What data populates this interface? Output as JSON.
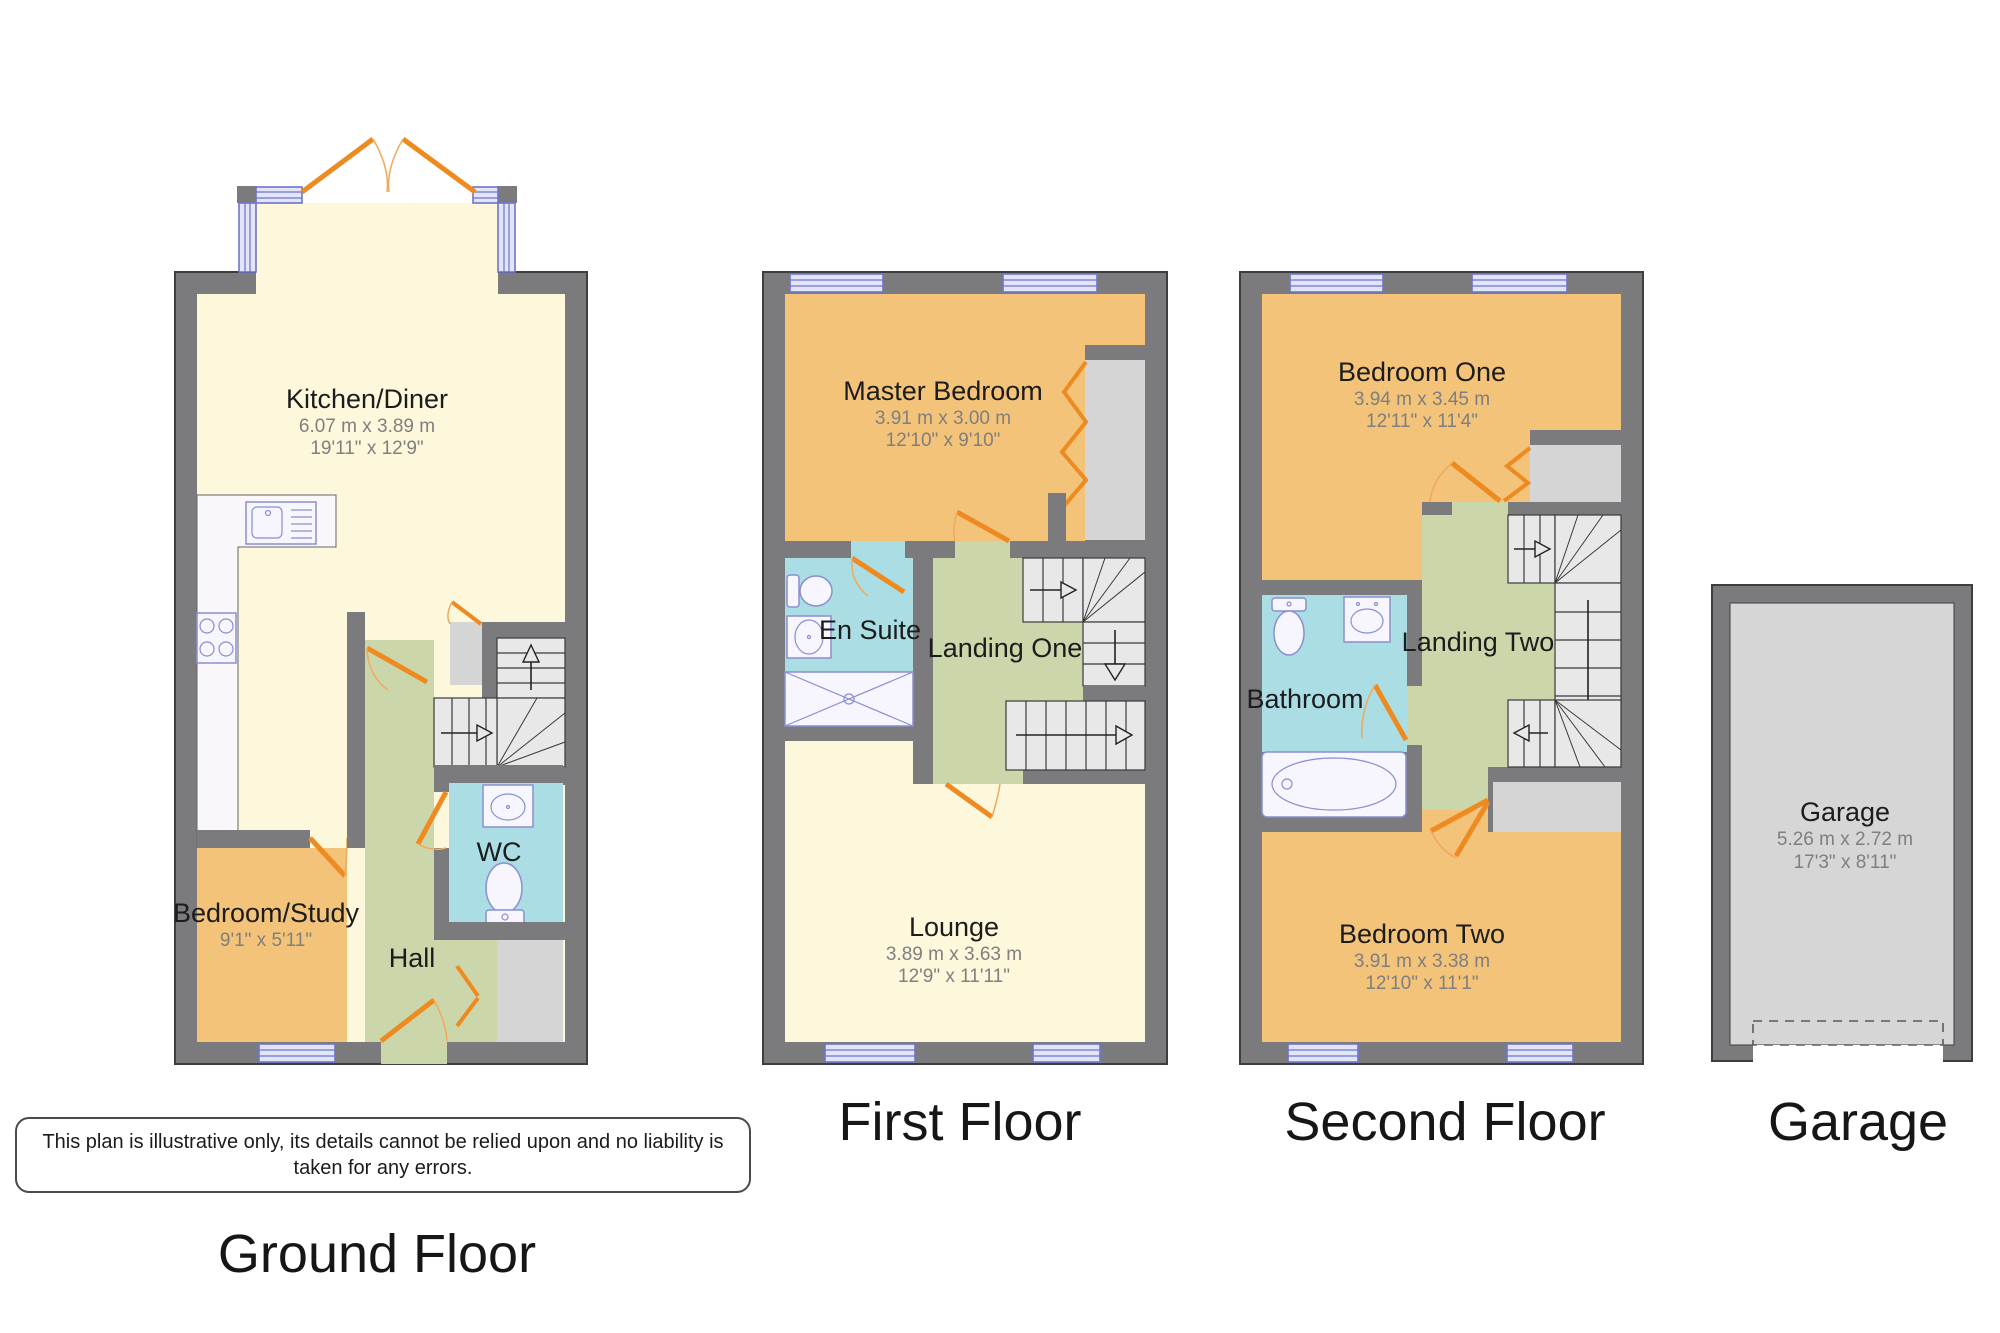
{
  "disclaimer": "This plan is illustrative only, its details cannot be relied upon and no liability is taken for any errors.",
  "floors": {
    "ground": {
      "title": "Ground Floor",
      "rooms": {
        "kitchen": {
          "name": "Kitchen/Diner",
          "metric": "6.07 m x 3.89 m",
          "imperial": "19'11\" x 12'9\""
        },
        "bedroom_study": {
          "name": "Bedroom/Study",
          "imperial": "9'1\" x 5'11\""
        },
        "hall": {
          "name": "Hall"
        },
        "wc": {
          "name": "WC"
        }
      }
    },
    "first": {
      "title": "First Floor",
      "rooms": {
        "master_bedroom": {
          "name": "Master Bedroom",
          "metric": "3.91 m x 3.00 m",
          "imperial": "12'10\" x 9'10\""
        },
        "en_suite": {
          "name": "En Suite"
        },
        "landing_one": {
          "name": "Landing One"
        },
        "lounge": {
          "name": "Lounge",
          "metric": "3.89 m x 3.63 m",
          "imperial": "12'9\" x 11'11\""
        }
      }
    },
    "second": {
      "title": "Second Floor",
      "rooms": {
        "bedroom_one": {
          "name": "Bedroom One",
          "metric": "3.94 m x 3.45 m",
          "imperial": "12'11\" x 11'4\""
        },
        "bathroom": {
          "name": "Bathroom"
        },
        "landing_two": {
          "name": "Landing Two"
        },
        "bedroom_two": {
          "name": "Bedroom Two",
          "metric": "3.91 m x 3.38 m",
          "imperial": "12'10\" x 11'1\""
        }
      }
    },
    "garage": {
      "title": "Garage",
      "rooms": {
        "garage": {
          "name": "Garage",
          "metric": "5.26 m x 2.72 m",
          "imperial": "17'3\" x 8'11\""
        }
      }
    }
  },
  "colors": {
    "wall": "#7b7b7d",
    "kitchen_lounge_floor": "#fdf8dc",
    "bedroom_floor": "#f2c379",
    "hall_landing_floor": "#ccd6ab",
    "bathroom_floor": "#abdee4",
    "storage_floor": "#d5d5d5",
    "door": "#ee8a1f",
    "window": "#e2e5f7"
  }
}
